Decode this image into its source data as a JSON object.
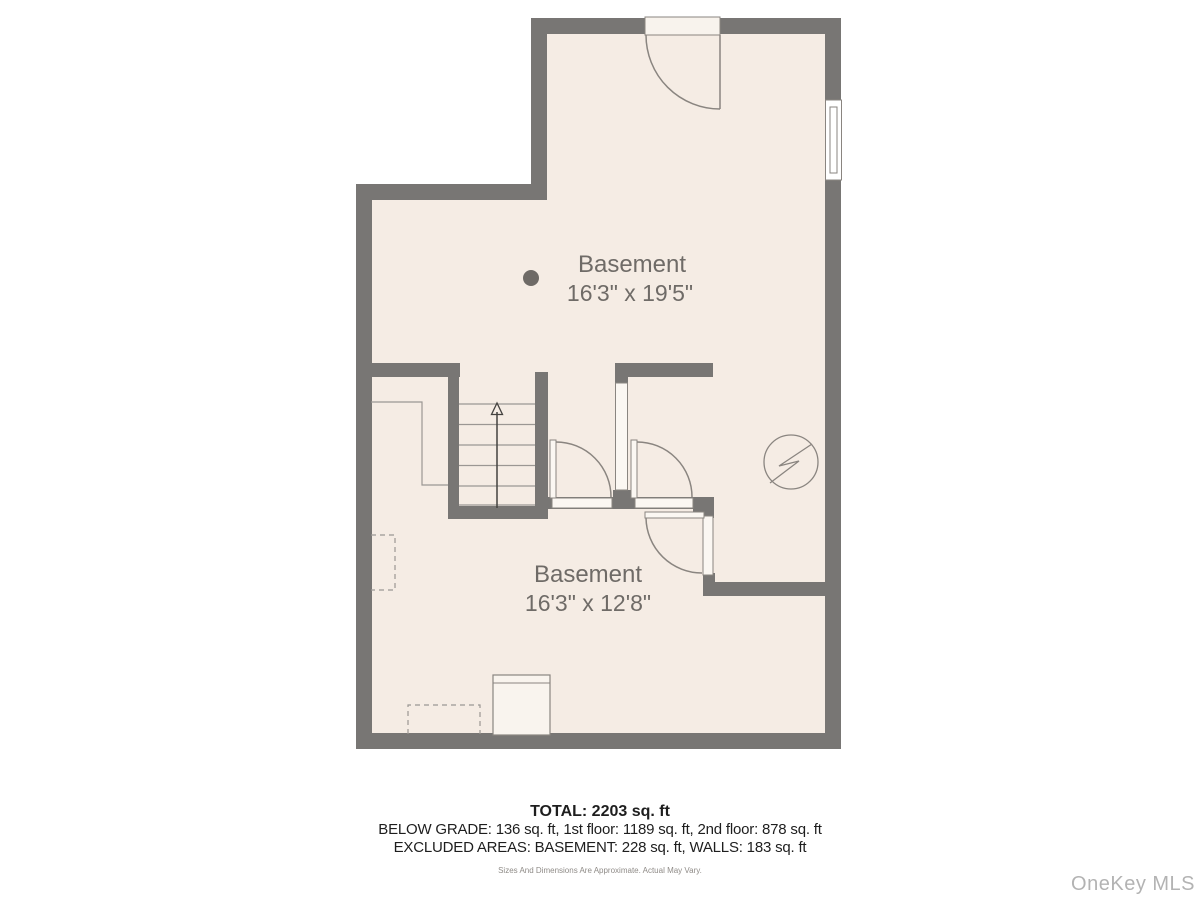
{
  "floorplan": {
    "colors": {
      "wall": "#787674",
      "floor": "#f5ece4",
      "line": "#8a8580",
      "thin_line": "#9b9793",
      "label": "#6f6b67",
      "opening_fill": "#fbf7f2",
      "arrow": "#44423f"
    },
    "rooms": [
      {
        "name": "Basement",
        "dimensions": "16'3\" x 19'5\""
      },
      {
        "name": "Basement",
        "dimensions": "16'3\" x 12'8\""
      }
    ],
    "icons": {
      "stairs_direction_arrow": "↑",
      "electrical_panel_symbol": "⚡"
    }
  },
  "summary": {
    "total": "TOTAL: 2203 sq. ft",
    "below_grade": "BELOW GRADE: 136 sq. ft, 1st floor: 1189 sq. ft, 2nd floor: 878 sq. ft",
    "excluded": "EXCLUDED AREAS: BASEMENT: 228 sq. ft, WALLS: 183 sq. ft",
    "disclaimer": "Sizes And Dimensions Are Approximate. Actual May Vary."
  },
  "watermark": {
    "label": "OneKey MLS"
  }
}
